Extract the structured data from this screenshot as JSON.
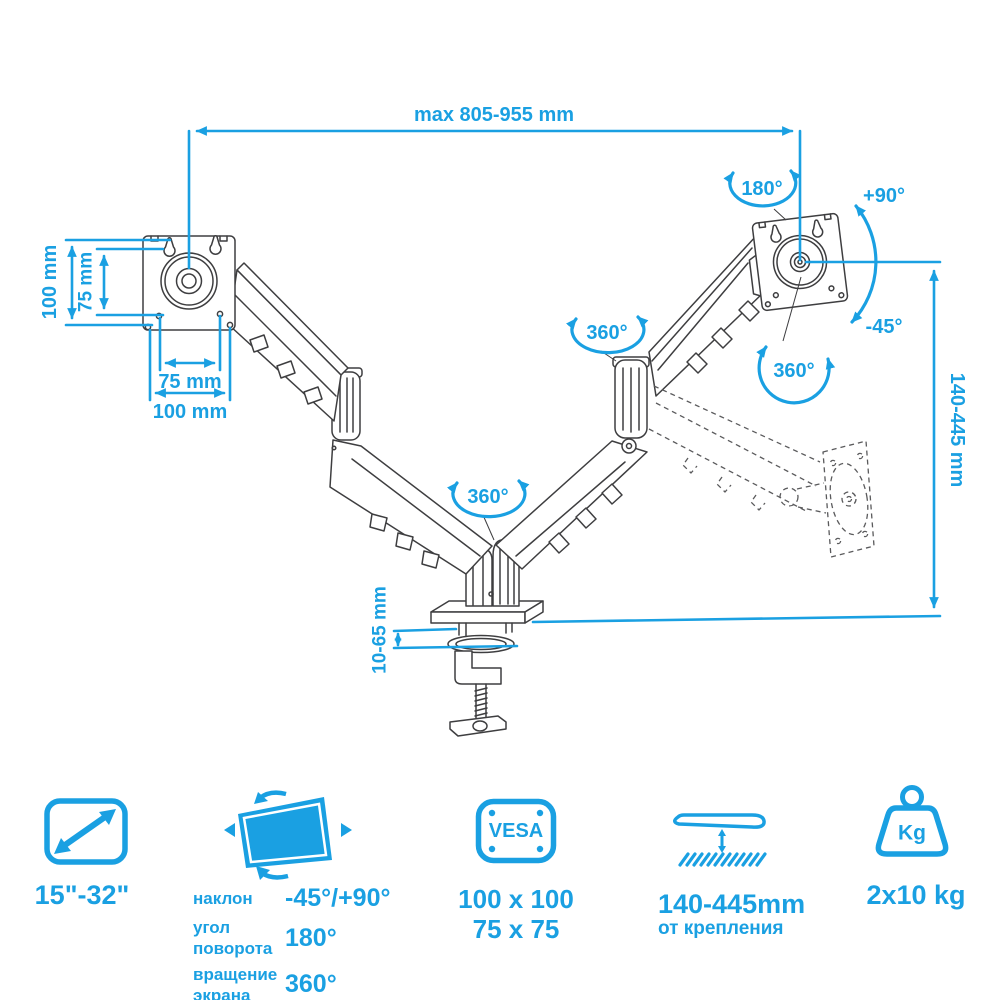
{
  "colors": {
    "accent": "#1aa0e2",
    "line_art": "#3e3e40"
  },
  "diagram": {
    "dim_width_max": "max 805-955 mm",
    "dim_vesa_height_100": "100 mm",
    "dim_vesa_height_75": "75 mm",
    "dim_vesa_width_75": "75 mm",
    "dim_vesa_width_100": "100 mm",
    "rot_swivel": "180°",
    "tilt_up": "+90°",
    "tilt_down": "-45°",
    "rot_plate": "360°",
    "rot_elbow": "360°",
    "rot_base": "360°",
    "dim_height_range": "140-445 mm",
    "dim_clamp_range": "10-65 mm"
  },
  "specs": {
    "screen_size": {
      "label": "15\"-32\""
    },
    "adjustments": {
      "rows": [
        {
          "name": "наклон",
          "value": "-45°/+90°"
        },
        {
          "name": "угол поворота",
          "value": "180°"
        },
        {
          "name": "вращение экрана",
          "value": "360°"
        }
      ]
    },
    "vesa": {
      "icon_text": "VESA",
      "sizes": [
        "100 x 100",
        "75 x 75"
      ]
    },
    "mount_distance": {
      "value": "140-445mm",
      "caption": "от крепления"
    },
    "max_load": {
      "icon_text": "Kg",
      "value": "2x10 kg"
    }
  }
}
